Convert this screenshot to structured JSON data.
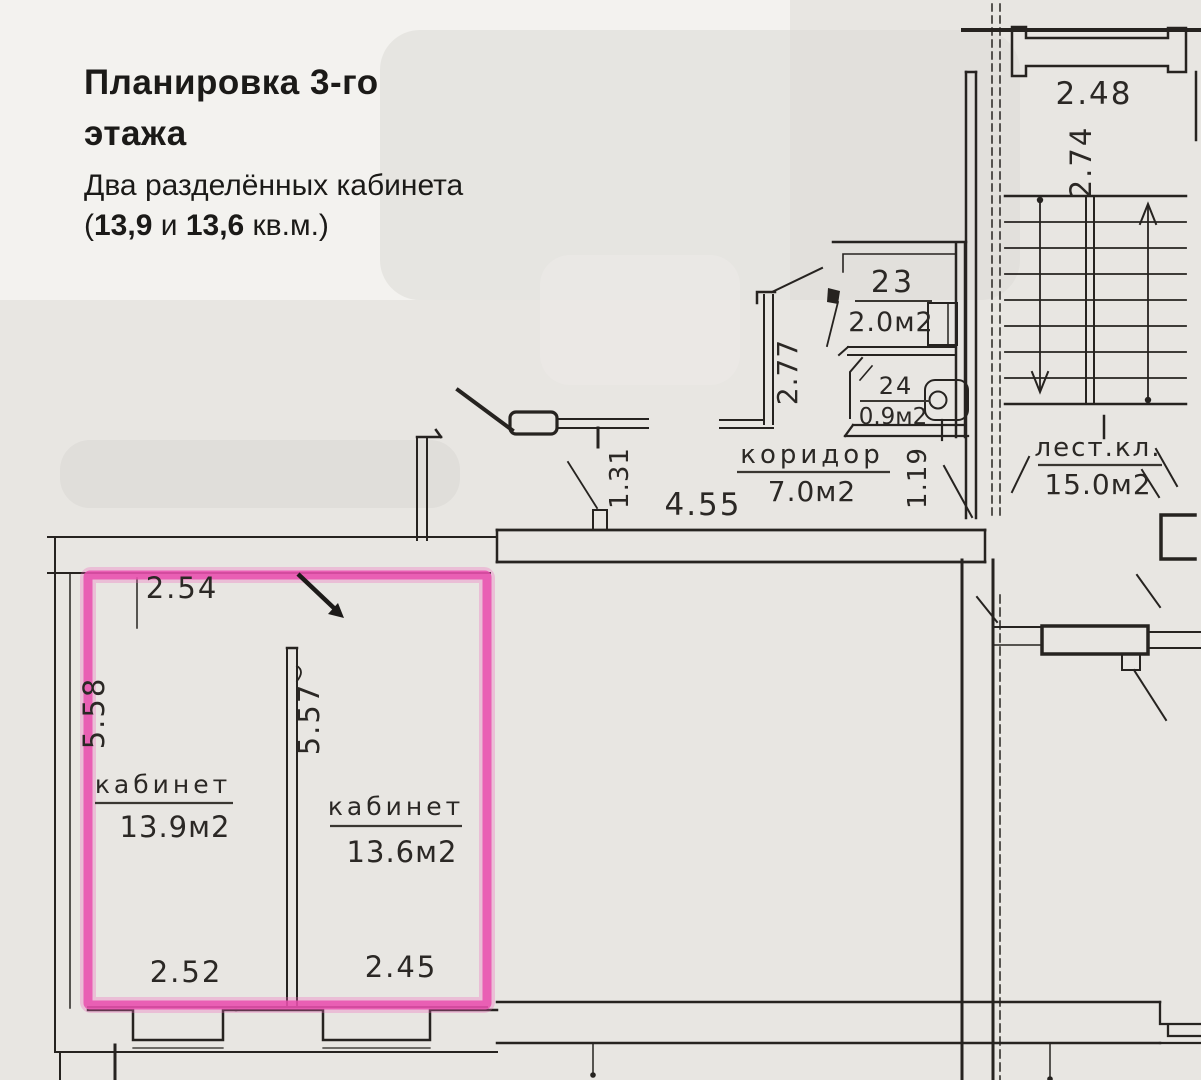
{
  "header": {
    "title_line1": "Планировка 3-го",
    "title_line2": "этажа",
    "subtitle": "Два разделённых кабинета",
    "area_prefix": "(",
    "area_bold1": "13,9",
    "area_mid": " и ",
    "area_bold2": "13,6",
    "area_suffix": " кв.м.)"
  },
  "plan": {
    "rooms": {
      "room23": {
        "number": "23",
        "area": "2.0м2"
      },
      "room24": {
        "number": "24",
        "area": "0.9м2"
      },
      "corridor": {
        "name": "коридор",
        "area": "7.0м2"
      },
      "stairwell": {
        "name": "лест.кл.",
        "area": "15.0м2"
      },
      "office1": {
        "name": "кабинет",
        "area": "13.9м2"
      },
      "office2": {
        "name": "кабинет",
        "area": "13.6м2"
      }
    },
    "dimensions": {
      "d248": "2.48",
      "d274": "2.74",
      "d277": "2.77",
      "d131": "1.31",
      "d455": "4.55",
      "d119": "1.19",
      "d254": "2.54",
      "d558": "5.58",
      "d557": "5.57",
      "d252": "2.52",
      "d245": "2.45"
    },
    "colors": {
      "highlight": "#e94fae",
      "ink": "#262320",
      "paper": "#e8e6e2"
    }
  }
}
